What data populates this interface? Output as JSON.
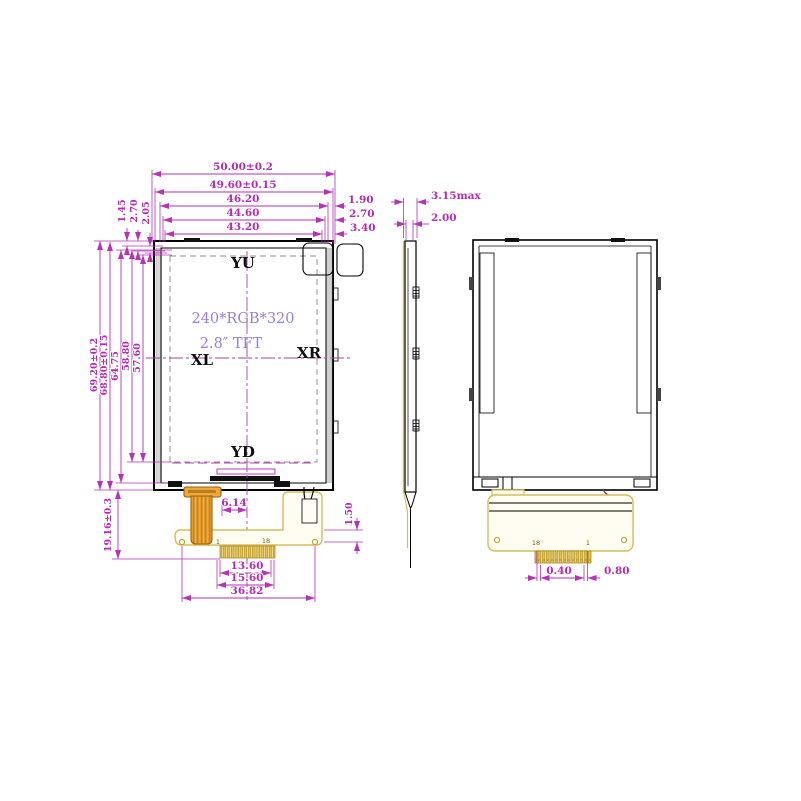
{
  "drawing_title": "2.8 inch TFT LCD module outline drawing",
  "front_view": {
    "top_dims": [
      "50.00±0.2",
      "49.60±0.15",
      "46.20",
      "44.60",
      "43.20"
    ],
    "top_right_dims": [
      "1.90",
      "2.70",
      "3.40"
    ],
    "top_left_dims": [
      "1.45",
      "2.70",
      "2.05"
    ],
    "left_dims": [
      "69.20±0.2",
      "68.80±0.15",
      "64.75",
      "58.80",
      "57.60"
    ],
    "bottom_left_dim": "19.16±0.3",
    "labels": {
      "top": "YU",
      "bottom": "YD",
      "left": "XL",
      "right": "XR"
    },
    "center_text": {
      "line1": "240*RGB*320",
      "line2": "2.8″ TFT"
    },
    "pins": {
      "first": "1",
      "last": "18"
    },
    "bottom_dims": {
      "tail_offset": "6.14",
      "fpc_step": "1.50",
      "fingers": "13.60",
      "fingers_outer": "15.60",
      "fpc_width": "36.82"
    }
  },
  "side_view": {
    "thickness_max": "3.15max",
    "thickness": "2.00"
  },
  "back_view": {
    "pins": {
      "left": "18",
      "right": "1"
    },
    "dims": {
      "finger_width": "0.40",
      "finger_pitch": "0.80"
    }
  },
  "colors": {
    "dimension": "#b632b6",
    "center_text": "#9a7fd6",
    "fpc_outline": "#d7bc5a",
    "gold_finger": "#e8c33c",
    "tail_orange": "#f0a838"
  }
}
